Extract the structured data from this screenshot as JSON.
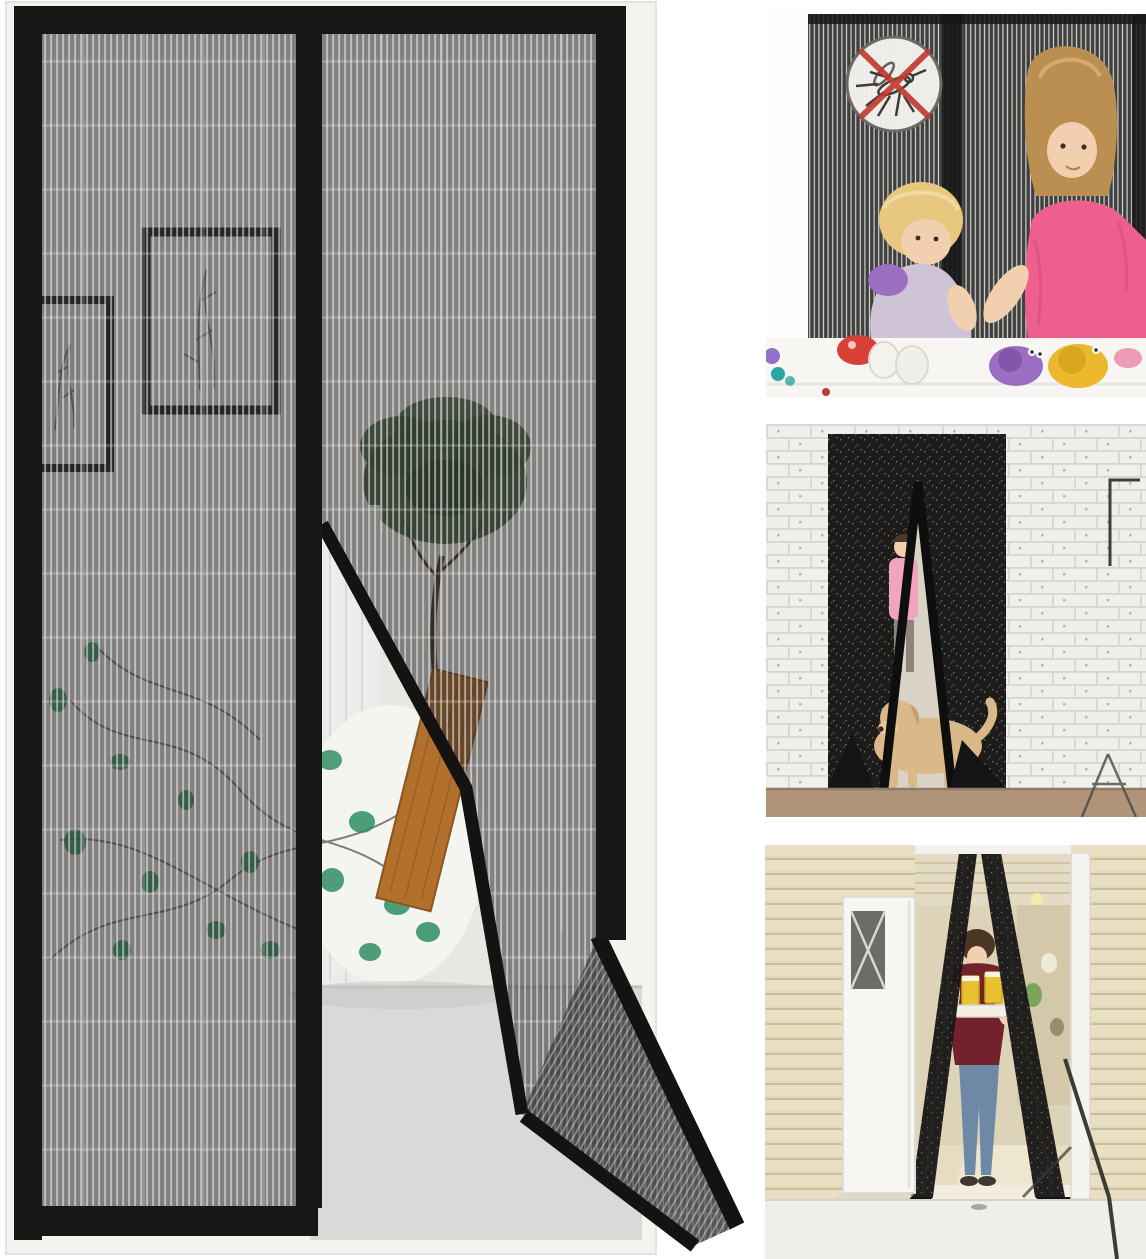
{
  "figures": {
    "main": {
      "label": "magnetic mesh screen door half-open on a doorway"
    },
    "kids": {
      "label": "children playing behind insect screen with no-mosquito symbol"
    },
    "dog": {
      "label": "dog walking through magnetic screen curtain"
    },
    "woman": {
      "label": "woman carrying drinks tray through magnetic screen curtain"
    }
  },
  "icons": {
    "no_mosquito": "no-mosquito-icon"
  },
  "palette": {
    "frame-black": "#181715",
    "doorframe-white": "#f4f3f0",
    "wall": "#e8e7e4",
    "curtain-white": "#ececea",
    "floor-gray": "#d7dad7",
    "tree-green": "#3f5a3b",
    "leaf-green": "#2f9065",
    "plank-brown": "#b3702d",
    "brick-wall": "#f0efeb",
    "brick-line": "#d7d6d1",
    "doorway-dark": "#1d1c1a",
    "interior-warm": "#d9d3c6",
    "dog-tan": "#d9b98a",
    "person-pink": "#efa6bc",
    "floor-brown": "#b0947a",
    "siding-beige": "#e9dfc2",
    "siding-line": "#cabe9b",
    "interior-beige": "#ddd3b9",
    "maroon": "#73222d",
    "jeans": "#6e89a6",
    "drink-yellow": "#e7c12f",
    "tray-white": "#f3efe5",
    "shirt-pink": "#ee5f90",
    "skin": "#f2cfae",
    "hair-blonde": "#e7c87e",
    "hair-brown": "#bb8f52",
    "toy-red": "#d94036",
    "toy-purple": "#9a6fc2",
    "toy-yellow": "#ecb82d",
    "toy-teal": "#2aa9a2",
    "icon-red": "#c0392b",
    "icon-bg": "#f5f3ef"
  }
}
